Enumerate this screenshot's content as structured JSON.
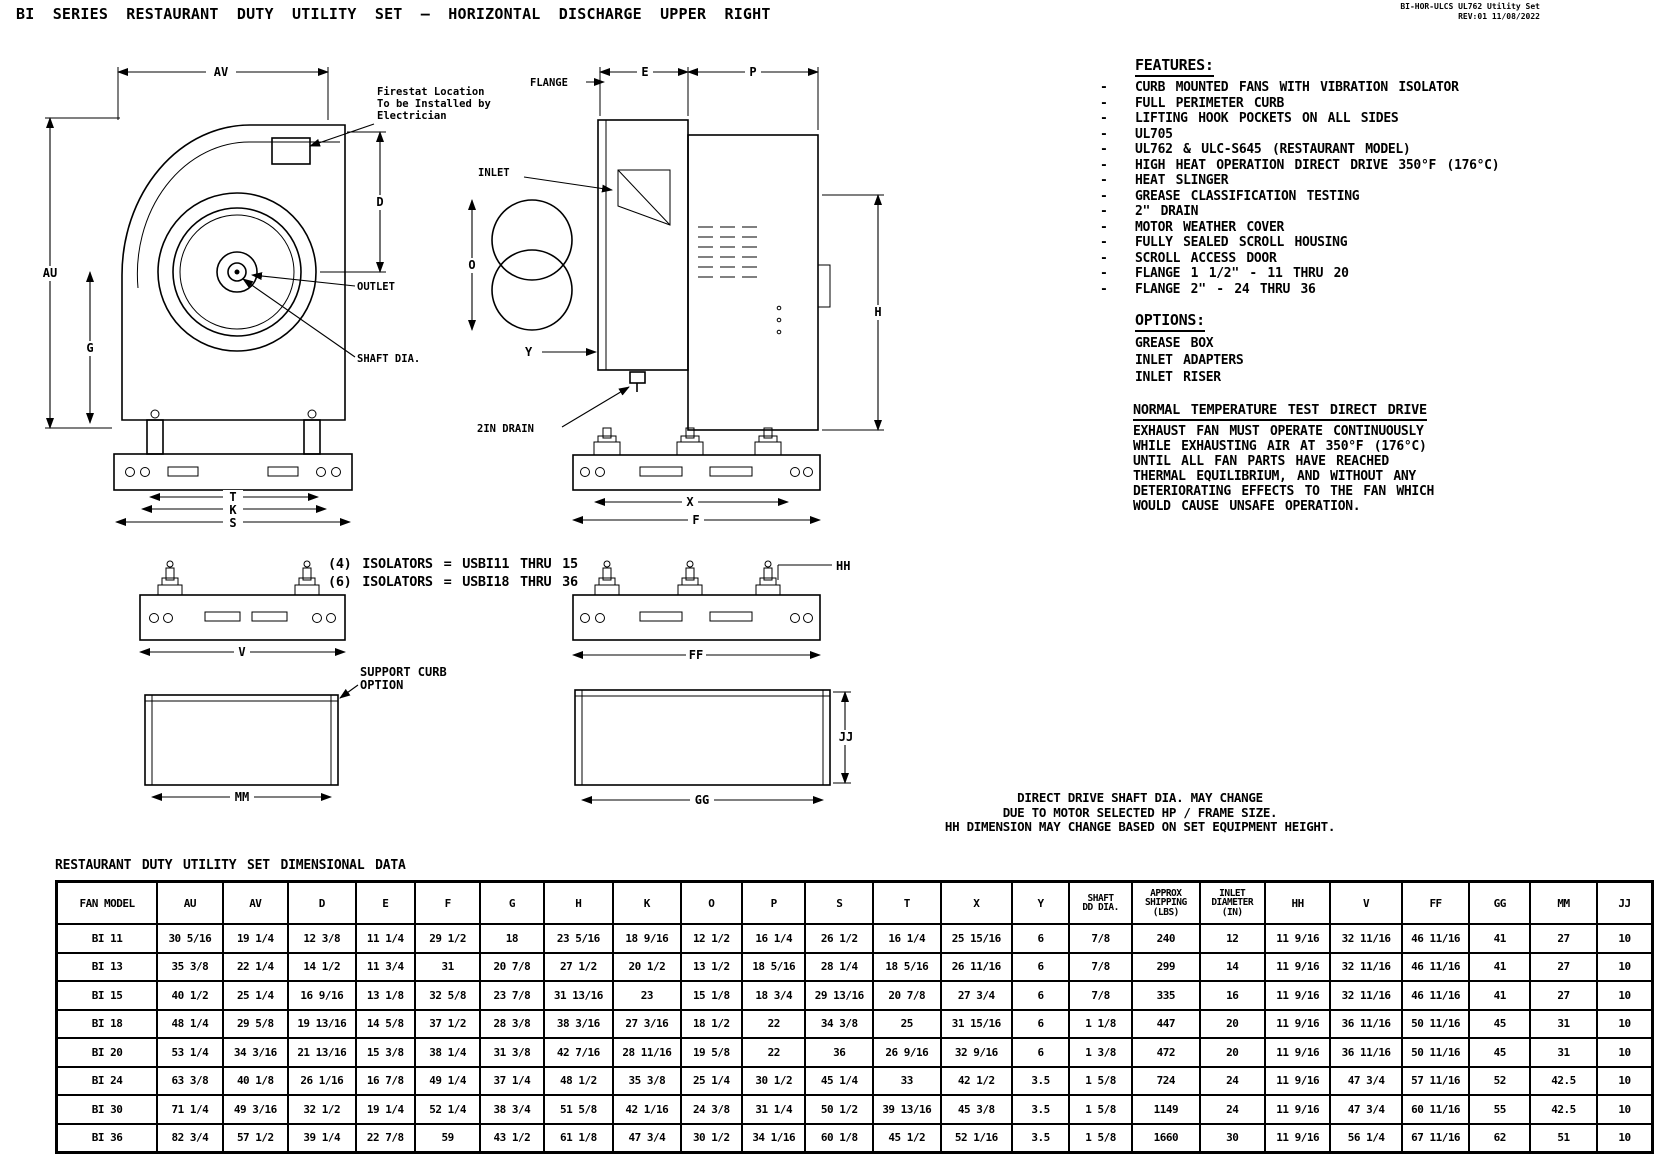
{
  "header": {
    "title": "BI SERIES RESTAURANT DUTY UTILITY SET — HORIZONTAL DISCHARGE UPPER RIGHT",
    "doc_ref_line1": "BI-HOR-ULCS UL762 Utility Set",
    "doc_ref_line2": "REV:01  11/08/2022"
  },
  "features": {
    "heading": "FEATURES:",
    "bullet": "-",
    "items": [
      "CURB MOUNTED FANS WITH VIBRATION ISOLATOR",
      "FULL PERIMETER CURB",
      "LIFTING HOOK POCKETS ON ALL SIDES",
      "UL705",
      "UL762 & ULC-S645 (RESTAURANT MODEL)",
      "HIGH HEAT OPERATION DIRECT DRIVE 350°F (176°C)",
      "HEAT SLINGER",
      "GREASE CLASSIFICATION TESTING",
      "2\" DRAIN",
      "MOTOR WEATHER COVER",
      "FULLY SEALED SCROLL HOUSING",
      "SCROLL ACCESS DOOR",
      "FLANGE 1 1/2\" - 11 THRU 20",
      "FLANGE 2\" - 24 THRU 36"
    ]
  },
  "options": {
    "heading": "OPTIONS:",
    "items": [
      "GREASE BOX",
      "INLET ADAPTERS",
      "INLET RISER"
    ]
  },
  "normal_temp_test": {
    "heading": "NORMAL TEMPERATURE TEST DIRECT DRIVE",
    "body_lines": [
      "EXHAUST FAN MUST OPERATE CONTINUOUSLY",
      "WHILE EXHAUSTING AIR AT 350°F (176°C)",
      "UNTIL ALL FAN PARTS HAVE REACHED",
      "THERMAL EQUILIBRIUM, AND WITHOUT ANY",
      "DETERIORATING EFFECTS TO THE FAN WHICH",
      "WOULD CAUSE UNSAFE OPERATION."
    ]
  },
  "isolator_notes": [
    "(4) ISOLATORS = USBI11 THRU 15",
    "(6) ISOLATORS = USBI18 THRU 36"
  ],
  "shaft_note_lines": [
    "DIRECT DRIVE SHAFT DIA. MAY CHANGE",
    "DUE TO MOTOR SELECTED HP / FRAME SIZE.",
    "HH DIMENSION MAY CHANGE BASED ON SET EQUIPMENT HEIGHT."
  ],
  "drawing": {
    "side": {
      "av": "AV",
      "au": "AU",
      "g": "G",
      "d": "D",
      "t": "T",
      "k": "K",
      "s": "S",
      "outlet": "OUTLET",
      "shaft_dia": "SHAFT DIA.",
      "firestat_1": "Firestat Location",
      "firestat_2": "To be Installed by",
      "firestat_3": "Electrician"
    },
    "front": {
      "flange": "FLANGE",
      "e": "E",
      "p": "P",
      "inlet": "INLET",
      "o": "O",
      "h": "H",
      "y": "Y",
      "drain": "2IN DRAIN",
      "x": "X",
      "f": "F"
    },
    "rails": {
      "v": "V",
      "hh": "HH",
      "ff": "FF"
    },
    "curbs": {
      "mm": "MM",
      "gg": "GG",
      "jj": "JJ",
      "support_1": "SUPPORT CURB",
      "support_2": "OPTION"
    }
  },
  "table": {
    "title": "RESTAURANT DUTY UTILITY SET DIMENSIONAL DATA",
    "headers": [
      "FAN MODEL",
      "AU",
      "AV",
      "D",
      "E",
      "F",
      "G",
      "H",
      "K",
      "O",
      "P",
      "S",
      "T",
      "X",
      "Y",
      "SHAFT\nDD DIA.",
      "APPROX\nSHIPPING\n(LBS)",
      "INLET\nDIAMETER\n(IN)",
      "HH",
      "V",
      "FF",
      "GG",
      "MM",
      "JJ"
    ],
    "rows": [
      [
        "BI 11",
        "30 5/16",
        "19 1/4",
        "12 3/8",
        "11 1/4",
        "29 1/2",
        "18",
        "23 5/16",
        "18 9/16",
        "12 1/2",
        "16 1/4",
        "26 1/2",
        "16 1/4",
        "25 15/16",
        "6",
        "7/8",
        "240",
        "12",
        "11 9/16",
        "32 11/16",
        "46 11/16",
        "41",
        "27",
        "10"
      ],
      [
        "BI 13",
        "35 3/8",
        "22 1/4",
        "14 1/2",
        "11 3/4",
        "31",
        "20 7/8",
        "27 1/2",
        "20 1/2",
        "13 1/2",
        "18 5/16",
        "28 1/4",
        "18 5/16",
        "26 11/16",
        "6",
        "7/8",
        "299",
        "14",
        "11 9/16",
        "32 11/16",
        "46 11/16",
        "41",
        "27",
        "10"
      ],
      [
        "BI 15",
        "40 1/2",
        "25 1/4",
        "16 9/16",
        "13 1/8",
        "32 5/8",
        "23 7/8",
        "31 13/16",
        "23",
        "15 1/8",
        "18 3/4",
        "29 13/16",
        "20 7/8",
        "27 3/4",
        "6",
        "7/8",
        "335",
        "16",
        "11 9/16",
        "32 11/16",
        "46 11/16",
        "41",
        "27",
        "10"
      ],
      [
        "BI 18",
        "48 1/4",
        "29 5/8",
        "19 13/16",
        "14 5/8",
        "37 1/2",
        "28 3/8",
        "38 3/16",
        "27 3/16",
        "18 1/2",
        "22",
        "34 3/8",
        "25",
        "31 15/16",
        "6",
        "1 1/8",
        "447",
        "20",
        "11 9/16",
        "36 11/16",
        "50 11/16",
        "45",
        "31",
        "10"
      ],
      [
        "BI 20",
        "53 1/4",
        "34 3/16",
        "21 13/16",
        "15 3/8",
        "38 1/4",
        "31 3/8",
        "42 7/16",
        "28 11/16",
        "19 5/8",
        "22",
        "36",
        "26 9/16",
        "32 9/16",
        "6",
        "1 3/8",
        "472",
        "20",
        "11 9/16",
        "36 11/16",
        "50 11/16",
        "45",
        "31",
        "10"
      ],
      [
        "BI 24",
        "63 3/8",
        "40 1/8",
        "26 1/16",
        "16 7/8",
        "49 1/4",
        "37 1/4",
        "48 1/2",
        "35 3/8",
        "25 1/4",
        "30 1/2",
        "45 1/4",
        "33",
        "42 1/2",
        "3.5",
        "1 5/8",
        "724",
        "24",
        "11 9/16",
        "47 3/4",
        "57 11/16",
        "52",
        "42.5",
        "10"
      ],
      [
        "BI 30",
        "71 1/4",
        "49 3/16",
        "32 1/2",
        "19 1/4",
        "52 1/4",
        "38 3/4",
        "51 5/8",
        "42 1/16",
        "24 3/8",
        "31 1/4",
        "50 1/2",
        "39 13/16",
        "45 3/8",
        "3.5",
        "1 5/8",
        "1149",
        "24",
        "11 9/16",
        "47 3/4",
        "60 11/16",
        "55",
        "42.5",
        "10"
      ],
      [
        "BI 36",
        "82 3/4",
        "57 1/2",
        "39 1/4",
        "22 7/8",
        "59",
        "43 1/2",
        "61 1/8",
        "47 3/4",
        "30 1/2",
        "34 1/16",
        "60 1/8",
        "45 1/2",
        "52 1/16",
        "3.5",
        "1 5/8",
        "1660",
        "30",
        "11 9/16",
        "56 1/4",
        "67 11/16",
        "62",
        "51",
        "10"
      ]
    ]
  }
}
